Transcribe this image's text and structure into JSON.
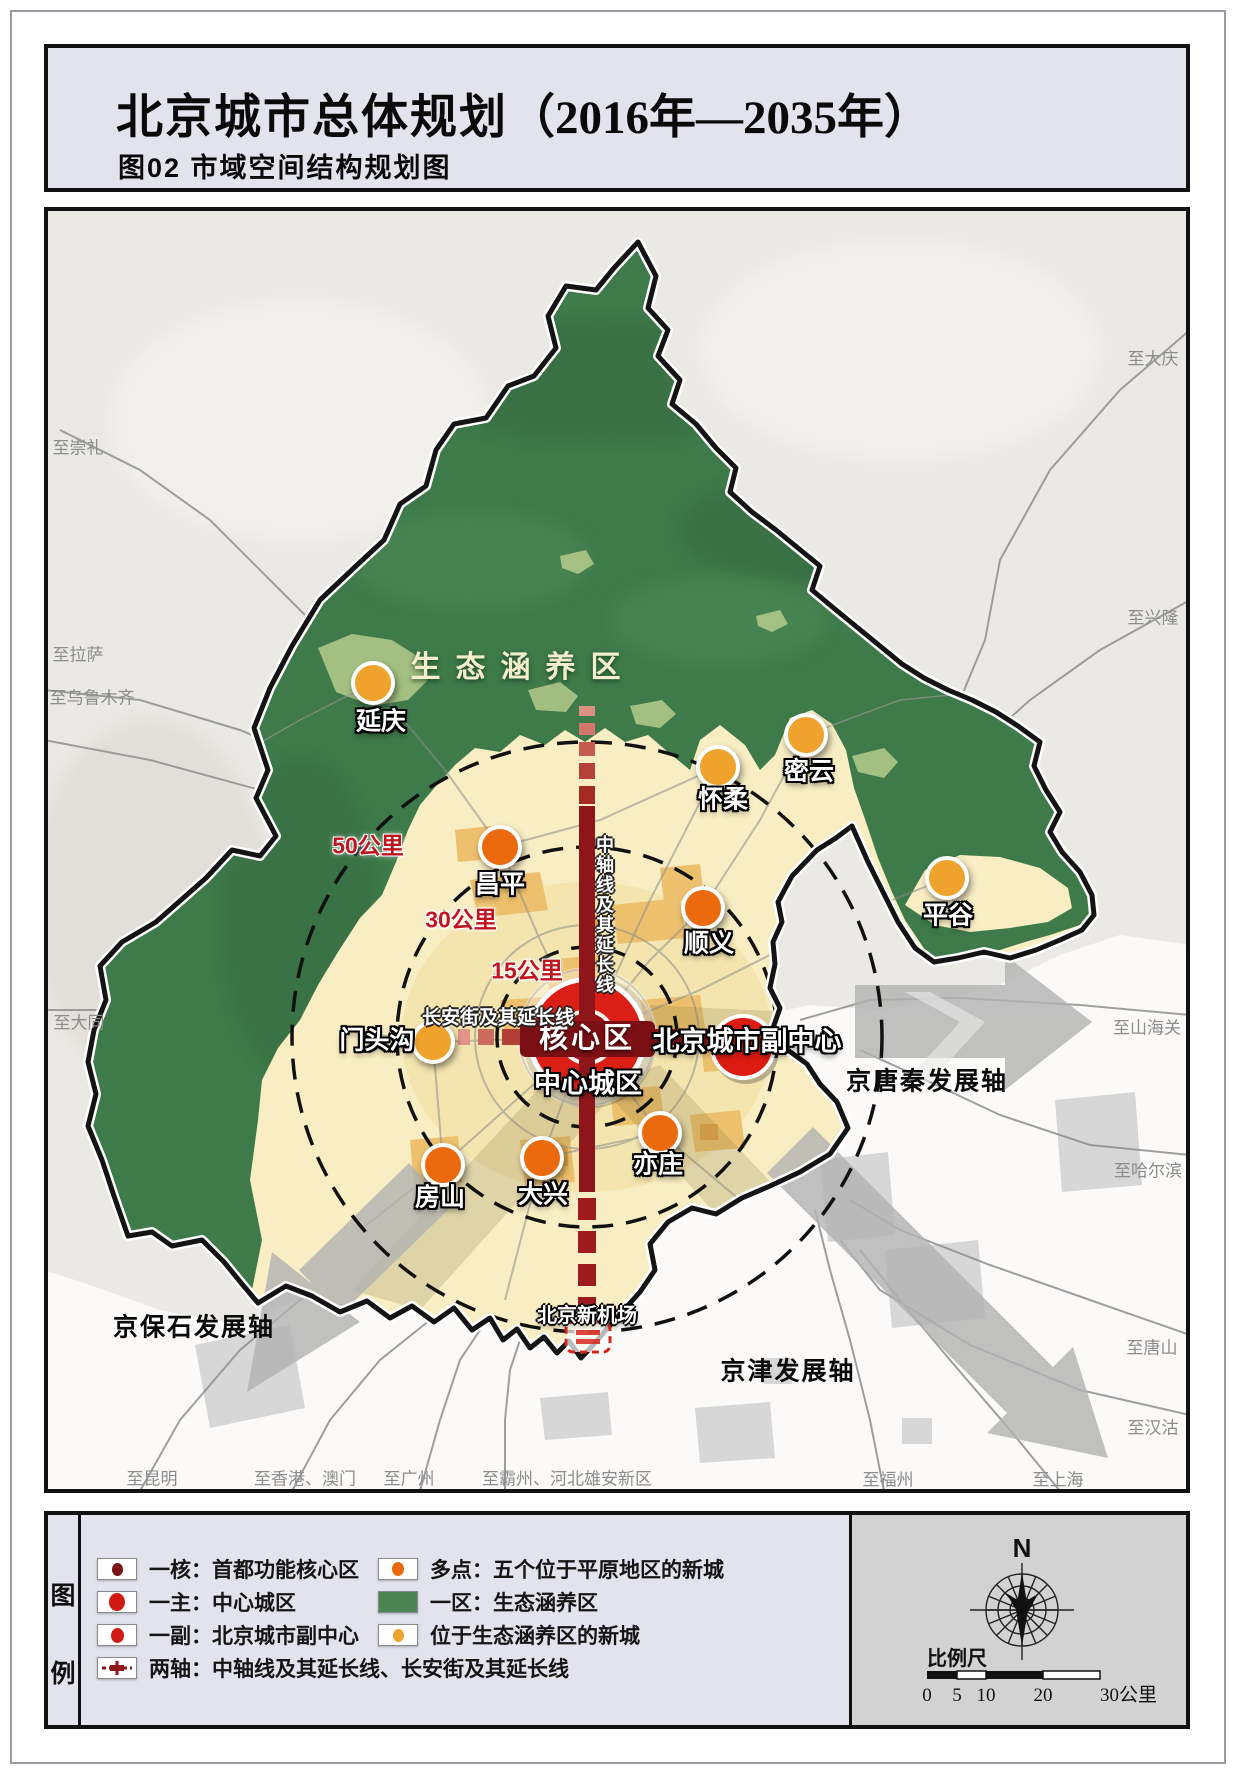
{
  "title": {
    "main": "北京城市总体规划",
    "years": "（2016年—2035年）",
    "subtitle": "图02  市域空间结构规划图"
  },
  "map": {
    "region_label": "生态涵养区",
    "cities": [
      {
        "name": "延庆",
        "x": 373,
        "y": 683,
        "type": "eco"
      },
      {
        "name": "密云",
        "x": 806,
        "y": 735,
        "type": "eco"
      },
      {
        "name": "怀柔",
        "x": 718,
        "y": 767,
        "type": "eco"
      },
      {
        "name": "平谷",
        "x": 947,
        "y": 878,
        "type": "eco"
      },
      {
        "name": "门头沟",
        "x": 433,
        "y": 1042,
        "type": "eco"
      },
      {
        "name": "昌平",
        "x": 500,
        "y": 847,
        "type": "plain"
      },
      {
        "name": "顺义",
        "x": 703,
        "y": 908,
        "type": "plain"
      },
      {
        "name": "房山",
        "x": 443,
        "y": 1165,
        "type": "plain"
      },
      {
        "name": "大兴",
        "x": 542,
        "y": 1158,
        "type": "plain"
      },
      {
        "name": "亦庄",
        "x": 660,
        "y": 1133,
        "type": "plain"
      }
    ],
    "labels": [
      {
        "text": "生态涵养区",
        "x": 523,
        "y": 668,
        "cls": "region"
      },
      {
        "text": "延庆",
        "x": 381,
        "y": 722,
        "cls": "city"
      },
      {
        "text": "密云",
        "x": 809,
        "y": 772,
        "cls": "city"
      },
      {
        "text": "怀柔",
        "x": 723,
        "y": 800,
        "cls": "city"
      },
      {
        "text": "平谷",
        "x": 948,
        "y": 916,
        "cls": "city"
      },
      {
        "text": "昌平",
        "x": 500,
        "y": 885,
        "cls": "city"
      },
      {
        "text": "顺义",
        "x": 709,
        "y": 944,
        "cls": "city"
      },
      {
        "text": "门头沟",
        "x": 377,
        "y": 1041,
        "cls": "city"
      },
      {
        "text": "房山",
        "x": 440,
        "y": 1198,
        "cls": "city"
      },
      {
        "text": "大兴",
        "x": 543,
        "y": 1195,
        "cls": "city"
      },
      {
        "text": "亦庄",
        "x": 658,
        "y": 1165,
        "cls": "city"
      },
      {
        "text": "核心区",
        "x": 587,
        "y": 1039,
        "cls": "core"
      },
      {
        "text": "中心城区",
        "x": 588,
        "y": 1084,
        "cls": "city-lg"
      },
      {
        "text": "北京城市副中心",
        "x": 747,
        "y": 1042,
        "cls": "city-lg"
      },
      {
        "text": "北京新机场",
        "x": 587,
        "y": 1316,
        "cls": "airport"
      },
      {
        "text": "50公里",
        "x": 368,
        "y": 846,
        "cls": "km"
      },
      {
        "text": "30公里",
        "x": 461,
        "y": 920,
        "cls": "km"
      },
      {
        "text": "15公里",
        "x": 527,
        "y": 971,
        "cls": "km"
      },
      {
        "text": "长安街及其延长线",
        "x": 498,
        "y": 1018,
        "cls": "axis-h"
      },
      {
        "text": "中轴线及其延长线",
        "x": 604,
        "y": 915,
        "cls": "axis-v"
      },
      {
        "text": "京唐秦发展轴",
        "x": 927,
        "y": 1082,
        "cls": "dev"
      },
      {
        "text": "京津发展轴",
        "x": 788,
        "y": 1372,
        "cls": "dev"
      },
      {
        "text": "京保石发展轴",
        "x": 194,
        "y": 1328,
        "cls": "dev"
      },
      {
        "text": "至大庆",
        "x": 1153,
        "y": 359,
        "cls": "road"
      },
      {
        "text": "至崇礼",
        "x": 78,
        "y": 448,
        "cls": "road"
      },
      {
        "text": "至拉萨",
        "x": 78,
        "y": 655,
        "cls": "road"
      },
      {
        "text": "至乌鲁木齐",
        "x": 92,
        "y": 698,
        "cls": "road"
      },
      {
        "text": "至兴隆",
        "x": 1153,
        "y": 618,
        "cls": "road"
      },
      {
        "text": "至大同",
        "x": 79,
        "y": 1023,
        "cls": "road"
      },
      {
        "text": "至山海关",
        "x": 1147,
        "y": 1028,
        "cls": "road"
      },
      {
        "text": "至哈尔滨",
        "x": 1148,
        "y": 1171,
        "cls": "road"
      },
      {
        "text": "至唐山",
        "x": 1152,
        "y": 1348,
        "cls": "road"
      },
      {
        "text": "至汉沽",
        "x": 1153,
        "y": 1428,
        "cls": "road"
      },
      {
        "text": "至昆明",
        "x": 152,
        "y": 1479,
        "cls": "road"
      },
      {
        "text": "至香港、澳门",
        "x": 305,
        "y": 1479,
        "cls": "road"
      },
      {
        "text": "至广州",
        "x": 409,
        "y": 1479,
        "cls": "road"
      },
      {
        "text": "至霸州、河北雄安新区",
        "x": 567,
        "y": 1479,
        "cls": "road"
      },
      {
        "text": "至福州",
        "x": 888,
        "y": 1480,
        "cls": "road"
      },
      {
        "text": "至上海",
        "x": 1058,
        "y": 1480,
        "cls": "road"
      }
    ],
    "rings_km": [
      15,
      30,
      50
    ],
    "colors": {
      "eco_green": "#3e7a4a",
      "plain": "#f8edc3",
      "urban_patch": "#ecc06c",
      "new_town_plain": "#ec6a0e",
      "new_town_eco": "#efa32c",
      "central_city_red": "#db1f16",
      "core_dark_red": "#9c1113",
      "axis_red": "#8e161b"
    }
  },
  "legend": {
    "panel_chars": [
      "图",
      "例"
    ],
    "items_left": [
      {
        "sym": "dot-core",
        "label": "一核：首都功能核心区"
      },
      {
        "sym": "dot-main",
        "label": "一主：中心城区"
      },
      {
        "sym": "dot-sub",
        "label": "一副：北京城市副中心"
      },
      {
        "sym": "axis",
        "label": "两轴：中轴线及其延长线、长安街及其延长线"
      }
    ],
    "items_right": [
      {
        "sym": "dot-plain",
        "label": "多点：五个位于平原地区的新城"
      },
      {
        "sym": "rect-eco",
        "label": "一区：生态涵养区"
      },
      {
        "sym": "dot-eco",
        "label": "位于生态涵养区的新城"
      }
    ],
    "north_label": "N",
    "scale_label": "比例尺",
    "scale_ticks": [
      "0",
      "5",
      "10",
      "20",
      "30公里"
    ]
  }
}
